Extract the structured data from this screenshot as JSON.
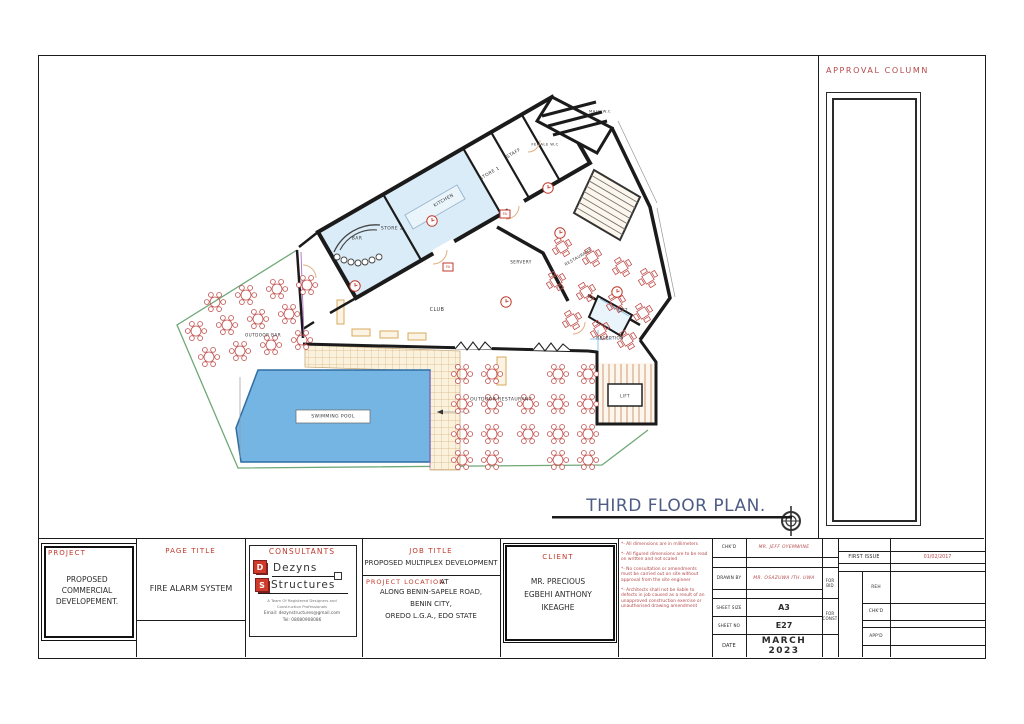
{
  "plan": {
    "title": "THIRD FLOOR PLAN.",
    "approval_label": "APPROVAL COLUMN",
    "fa_label": "FA",
    "rooms": {
      "male_wc": "MALE W.C",
      "female_wc": "FEMALE W.C",
      "staff": "STAFF",
      "store1": "STORE 1",
      "store2": "STORE 2",
      "kitchen": "KITCHEN",
      "bar": "BAR",
      "club": "CLUB",
      "servery": "SERVERY",
      "restaurant": "RESTAURANT",
      "lift_upper": "LIFT",
      "reception": "RECEPTION",
      "lift_lower": "LIFT",
      "outdoor_bar": "OUTDOOR BAR",
      "outdoor_restaurant": "OUTDOOR RESTAURANT",
      "swimming_pool": "SWIMMING POOL"
    }
  },
  "title_block": {
    "project": {
      "label": "PROJECT",
      "value": "PROPOSED COMMERCIAL DEVELOPEMENT."
    },
    "page_title": {
      "label": "PAGE TITLE",
      "value": "FIRE ALARM SYSTEM"
    },
    "consultants": {
      "label": "CONSULTANTS",
      "logo_d": "D",
      "logo_s": "S",
      "name1": "Dezyns",
      "name2": "Structures",
      "tagline1": "A Team Of Registered Designers and",
      "tagline2": "Construction Professionals",
      "email": "Email: dezynstructures@gmail.com",
      "tel": "Tel: 08080908086"
    },
    "job_title": {
      "label": "JOB TITLE",
      "value": "PROPOSED MULTIPLEX DEVELOPMENT"
    },
    "project_location": {
      "label": "PROJECT LOCATION",
      "at": "AT",
      "line1": "ALONG BENIN-SAPELE ROAD,",
      "line2": "BENIN CITY,",
      "line3": "OREDO L.G.A., EDO STATE"
    },
    "client": {
      "label": "CLIENT",
      "line1": "MR. PRECIOUS",
      "line2": "EGBEHI ANTHONY",
      "line3": "IKEAGHE"
    },
    "notes": [
      "*- All dimensions are in millimeters",
      "*- All figured dimensions are to be read on written and not scaled",
      "*- No consultation or amendments must be carried out on site without approval from the site engineer",
      "*- Architects shall not be liable to defects in job caused as a result of an unapproved construction exercise or unauthorised drawing amendment"
    ],
    "approvals": {
      "chkd_label": "CHK'D",
      "chkd_value": "MR. JEFF OYEMWINE",
      "drawn_by_label": "DRAWN BY",
      "drawn_by_value": "MR. OSAZUWA ITH. UWA",
      "sheet_size_label": "SHEET SIZE",
      "sheet_size_value": "A3",
      "sheet_no_label": "SHEET NO",
      "sheet_no_value": "E27",
      "date_label": "DATE",
      "date_value": "MARCH 2023",
      "for_bid": "FOR BID",
      "for_const": "FOR CONST"
    },
    "revision": {
      "first_issue_label": "FIRST ISSUE",
      "first_issue_date": "01/02/2017",
      "reh": "REH",
      "chkd": "CHK'D",
      "appd": "APP'D"
    }
  }
}
